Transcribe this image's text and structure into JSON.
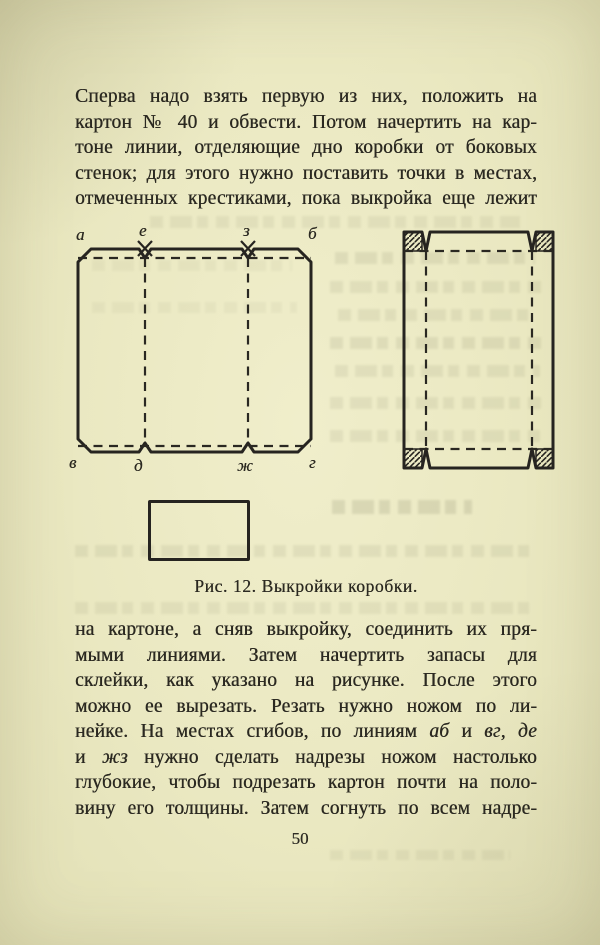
{
  "page": {
    "number": "50",
    "paper_color": "#eae8c1",
    "ink_color": "#2b2921"
  },
  "paragraph_top": {
    "lines": [
      "Сперва надо взять первую из них, положить на",
      "картон № 40 и обвести. Потом начертить на кар-",
      "тоне линии, отделяющие дно коробки от боковых",
      "стенок; для этого нужно поставить точки в местах,",
      "отмеченных крестиками, пока выкройка еще лежит"
    ]
  },
  "figure": {
    "caption": "Рис. 12. Выкройки коробки.",
    "labels": {
      "top_left": "а",
      "top_mid1": "е",
      "top_mid2": "з",
      "top_right": "б",
      "bottom_left": "в",
      "bottom_mid1": "д",
      "bottom_mid2": "ж",
      "bottom_right": "г"
    }
  },
  "paragraph_bottom": {
    "lines": [
      "на картоне, а сняв выкройку, соединить их пря-",
      "мыми линиями. Затем начертить запасы для",
      "склейки, как указано на рисунке. После этого",
      "можно ее вырезать. Резать нужно ножом по ли-",
      "нейке. На местах сгибов, по линиям аб и вг, де",
      "и жз нужно сделать надрезы ножом настолько",
      "глубокие, чтобы подрезать картон почти на поло-",
      "вину его толщины. Затем согнуть по всем надре-"
    ],
    "italic_words": [
      "аб",
      "вг",
      "де",
      "жз"
    ]
  }
}
